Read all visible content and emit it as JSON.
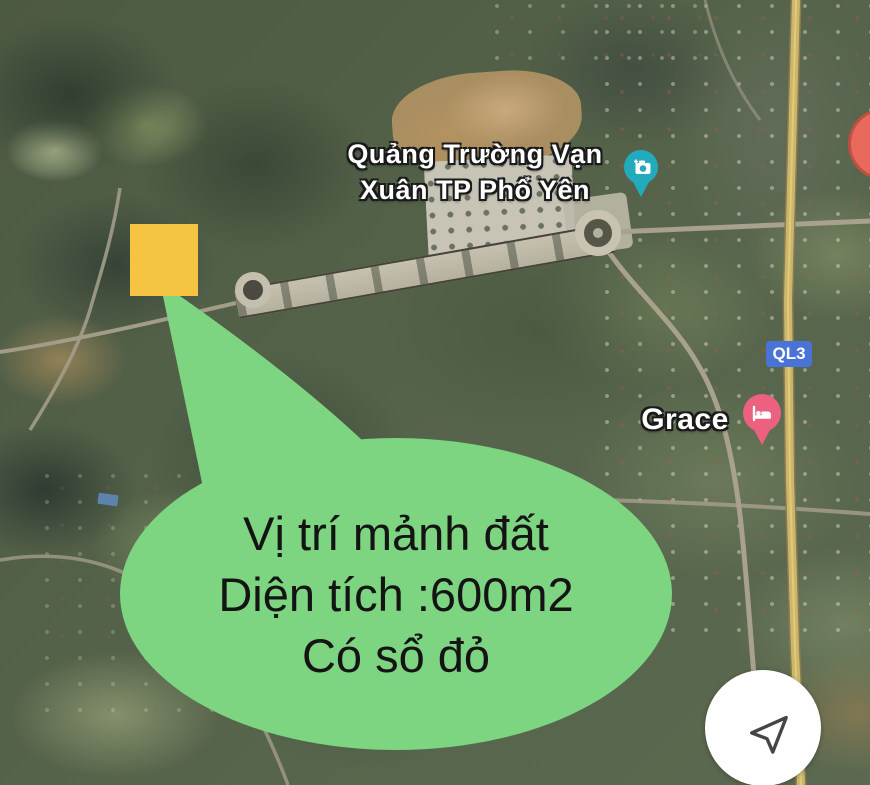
{
  "map": {
    "type": "satellite",
    "labels": {
      "plaza_line1": "Quảng Trường Vạn",
      "plaza_line2": "Xuân TP Phổ Yên",
      "hotel": "Grace",
      "route_badge": "QL3"
    },
    "colors": {
      "photo_pin": "#22abbd",
      "hotel_pin": "#ec6180",
      "route_badge_bg": "#4a73d8",
      "red_cluster": "#e96a5d",
      "ql3_road": "#ccb66e"
    }
  },
  "annotation": {
    "bubble_line1": "Vị trí mảnh đất",
    "bubble_line2": "Diện tích :600m2",
    "bubble_line3": "Có sổ đỏ",
    "bubble_color": "#7dd481",
    "plot_marker_color": "#f6c443"
  },
  "controls": {
    "navigation_icon": "send-arrow"
  }
}
